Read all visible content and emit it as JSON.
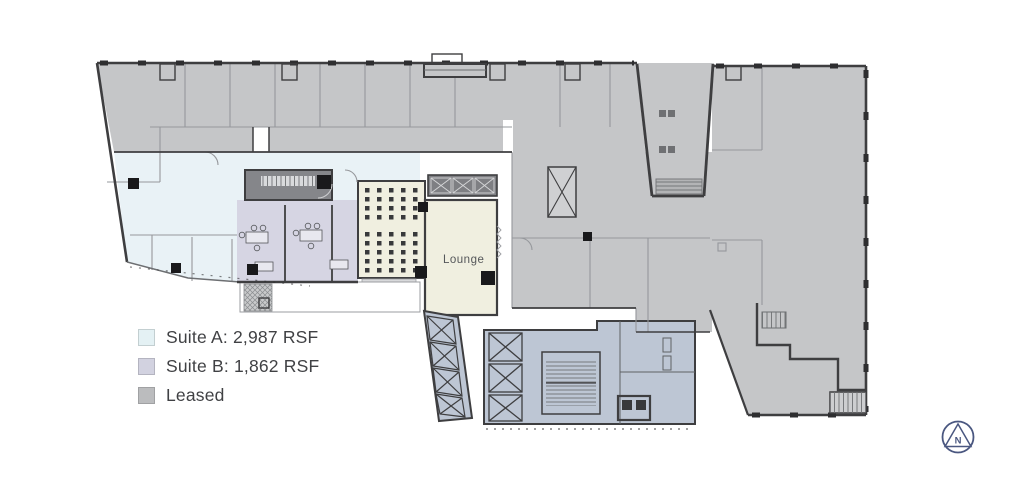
{
  "plan": {
    "lounge_label": "Lounge"
  },
  "legend": {
    "items": [
      {
        "label": "Suite A: 2,987 RSF",
        "color": "#E4F1F4"
      },
      {
        "label": "Suite B: 1,862 RSF",
        "color": "#D2D2E0"
      },
      {
        "label": "Leased",
        "color": "#BBBCBE"
      }
    ]
  },
  "compass": {
    "label": "N"
  },
  "colors": {
    "leased_fill": "#C5C6C8",
    "suite_a_fill": "#E9F2F6",
    "suite_b_fill": "#D6D5E3",
    "lounge_fill": "#F0EFE0",
    "core_fill": "#BDC6D4",
    "wall": "#3E3E40",
    "compass_accent": "#4A5780",
    "label_text": "#404144"
  }
}
